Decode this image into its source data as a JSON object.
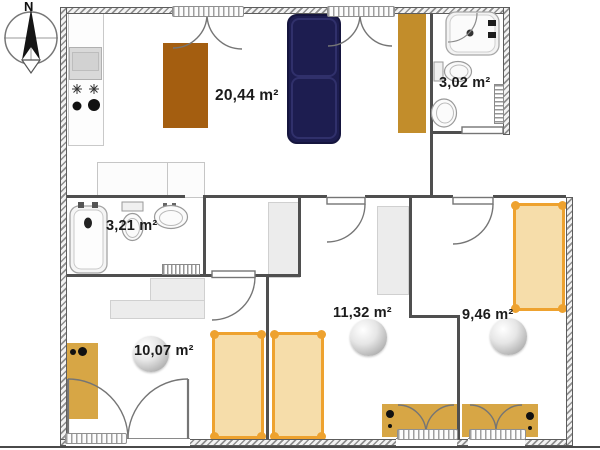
{
  "plan": {
    "compass_label": "N",
    "rooms": [
      {
        "id": "living-room",
        "area_label": "20,44 m²"
      },
      {
        "id": "bathroom-top-right",
        "area_label": "3,02 m²"
      },
      {
        "id": "bathroom-left",
        "area_label": "3,21 m²"
      },
      {
        "id": "bedroom-bottom-left",
        "area_label": "10,07 m²"
      },
      {
        "id": "bedroom-bottom-middle",
        "area_label": "11,32 m²"
      },
      {
        "id": "bedroom-bottom-right",
        "area_label": "9,46 m²"
      }
    ],
    "colors": {
      "interior_wall": "#4f4f4f",
      "bed_fill": "#f6ddaa",
      "bed_border": "#eea22f",
      "desk_gold": "#d7a645",
      "wardrobe_gold": "#c28d2b",
      "table_brown": "#a45e10",
      "sofa_navy": "#1d1d50",
      "furniture_gray": "#ececec"
    }
  }
}
